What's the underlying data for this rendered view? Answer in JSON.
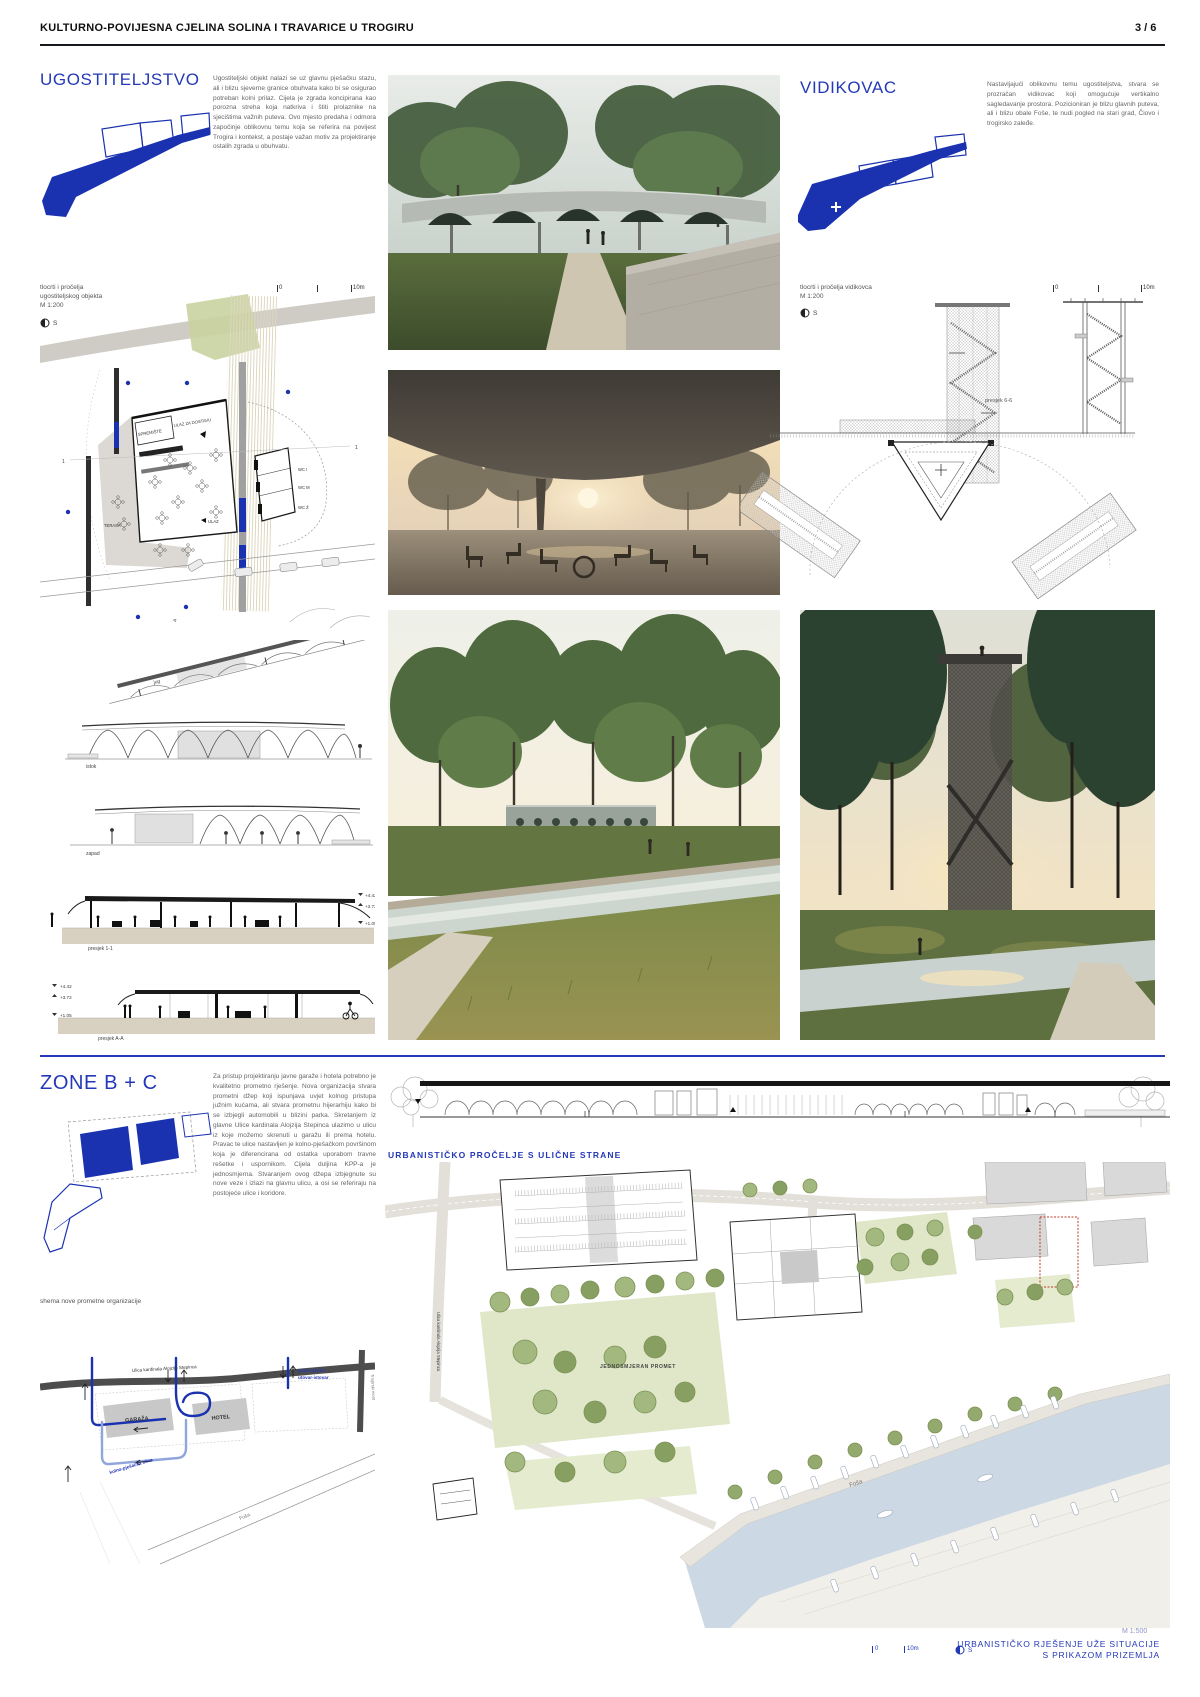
{
  "colors": {
    "accent": "#2439b8",
    "diagram_blue": "#1b32b0",
    "route_light": "#8fa5dc",
    "park_green": "#dfe7c8",
    "water": "#ccd9e4"
  },
  "header": {
    "title": "KULTURNO-POVIJESNA CJELINA SOLINA I TRAVARICE U TROGIRU",
    "page": "3 / 6"
  },
  "ugostiteljstvo": {
    "title": "UGOSTITELJSTVO",
    "paragraph": "Ugostiteljski objekt nalazi se uz glavnu pješačku stazu, ali i blizu sjeverne granice obuhvata kako bi se osigurao potreban kolni prilaz. Cijela je zgrada koncipirana kao porozna streha koja natkriva i štiti prolaznike na sjecištima važnih puteva. Ovo mjesto predaha i odmora započinje oblikovnu temu koja se referira na povijest Trogira i kontekst, a postaje važan motiv za projektiranje ostalih zgrada u obuhvatu.",
    "caption_line1": "tlocrti i pročelja",
    "caption_line2": "ugostiteljskog objekta",
    "caption_line3": "M 1:200",
    "north": "S",
    "scalebar_zero": "0",
    "scalebar_ten": "10m",
    "plan": {
      "spremiste": "SPREMIŠTE",
      "ulaz_dostava": "ULAZ ZA DOSTAVU",
      "wc_i": "WC I",
      "wc_m": "WC M",
      "wc_z": "WC Ž",
      "terasa": "TERASA",
      "ulaz": "ULAZ",
      "marker_1": "1",
      "marker_a": "A"
    },
    "elev": {
      "jug": "jug",
      "istok": "istok",
      "zapad": "zapad",
      "presjek11": "presjek 1-1",
      "presjekAA": "presjek A-A",
      "lvl1": "+4.42",
      "lvl2": "+3.72",
      "lvl3": "+1.05"
    }
  },
  "vidikovac": {
    "title": "VIDIKOVAC",
    "paragraph": "Nastavljajući oblikovnu temu ugostiteljstva, stvara se prozračan vidikovac koji omogućuje vertikalno sagledavanje prostora. Pozicioniran je blizu glavnih puteva, ali i blizu obale Foše, te nudi pogled na stari grad, Čiovo i trogirsko zaleđe.",
    "caption_line1": "tlocrti i pročelja vidikovca",
    "caption_line2": "M 1:200",
    "north": "S",
    "scalebar_zero": "0",
    "scalebar_ten": "10m",
    "presjek66": "presjek 6-6"
  },
  "zone": {
    "title": "ZONE B + C",
    "paragraph": "Za pristup projektiranju javne garaže i hotela potrebno je kvalitetno prometno rješenje. Nova organizacija stvara prometni džep koji ispunjava uvjet kolnog pristupa južnim kućama, ali stvara prometnu hijerarhiju kako bi se izbjegli automobili u blizini parka. Skretanjem iz glavne Ulice kardinala Alojzija Stepinca ulazimo u ulicu iz koje možemo skrenuti u garažu ili prema hotelu. Pravac te ulice nastavljen je kolno-pješačkom površinom koja je diferencirana od ostatka uporabom travne rešetke i uspornikom. Cijela duljina KPP-a je jednosmjerna. Stvaranjem ovog džepa izbjegnute su nove veze i izlazi na glavnu ulicu, a osi se referiraju na postojeće ulice i koridore.",
    "schema_label": "shema nove prometne organizacije",
    "street": "Ulica kardinala Alojzija Stepinca",
    "garage": "GARAŽA",
    "hotel": "HOTEL",
    "market_line1": "prilaz tržnici",
    "market_line2": "utovar-istovar",
    "pedestrian_street": "kolno-pješačka ulica",
    "fosa": "Foša",
    "bridge": "Trogirski most"
  },
  "urban": {
    "elevation_title": "URBANISTIČKO PROČELJE S ULIČNE STRANE",
    "oneway": "JEDNOSMJERAN PROMET",
    "fosa": "Foša",
    "street_vertical": "Ulica kardinala Alojzija Stepinca",
    "scale": "M 1:500",
    "title_line1": "URBANISTIČKO RJEŠENJE UŽE SITUACIJE",
    "title_line2": "S PRIKAZOM PRIZEMLJA",
    "scalebar_zero": "0",
    "scalebar_ten": "10m",
    "north": "S"
  }
}
